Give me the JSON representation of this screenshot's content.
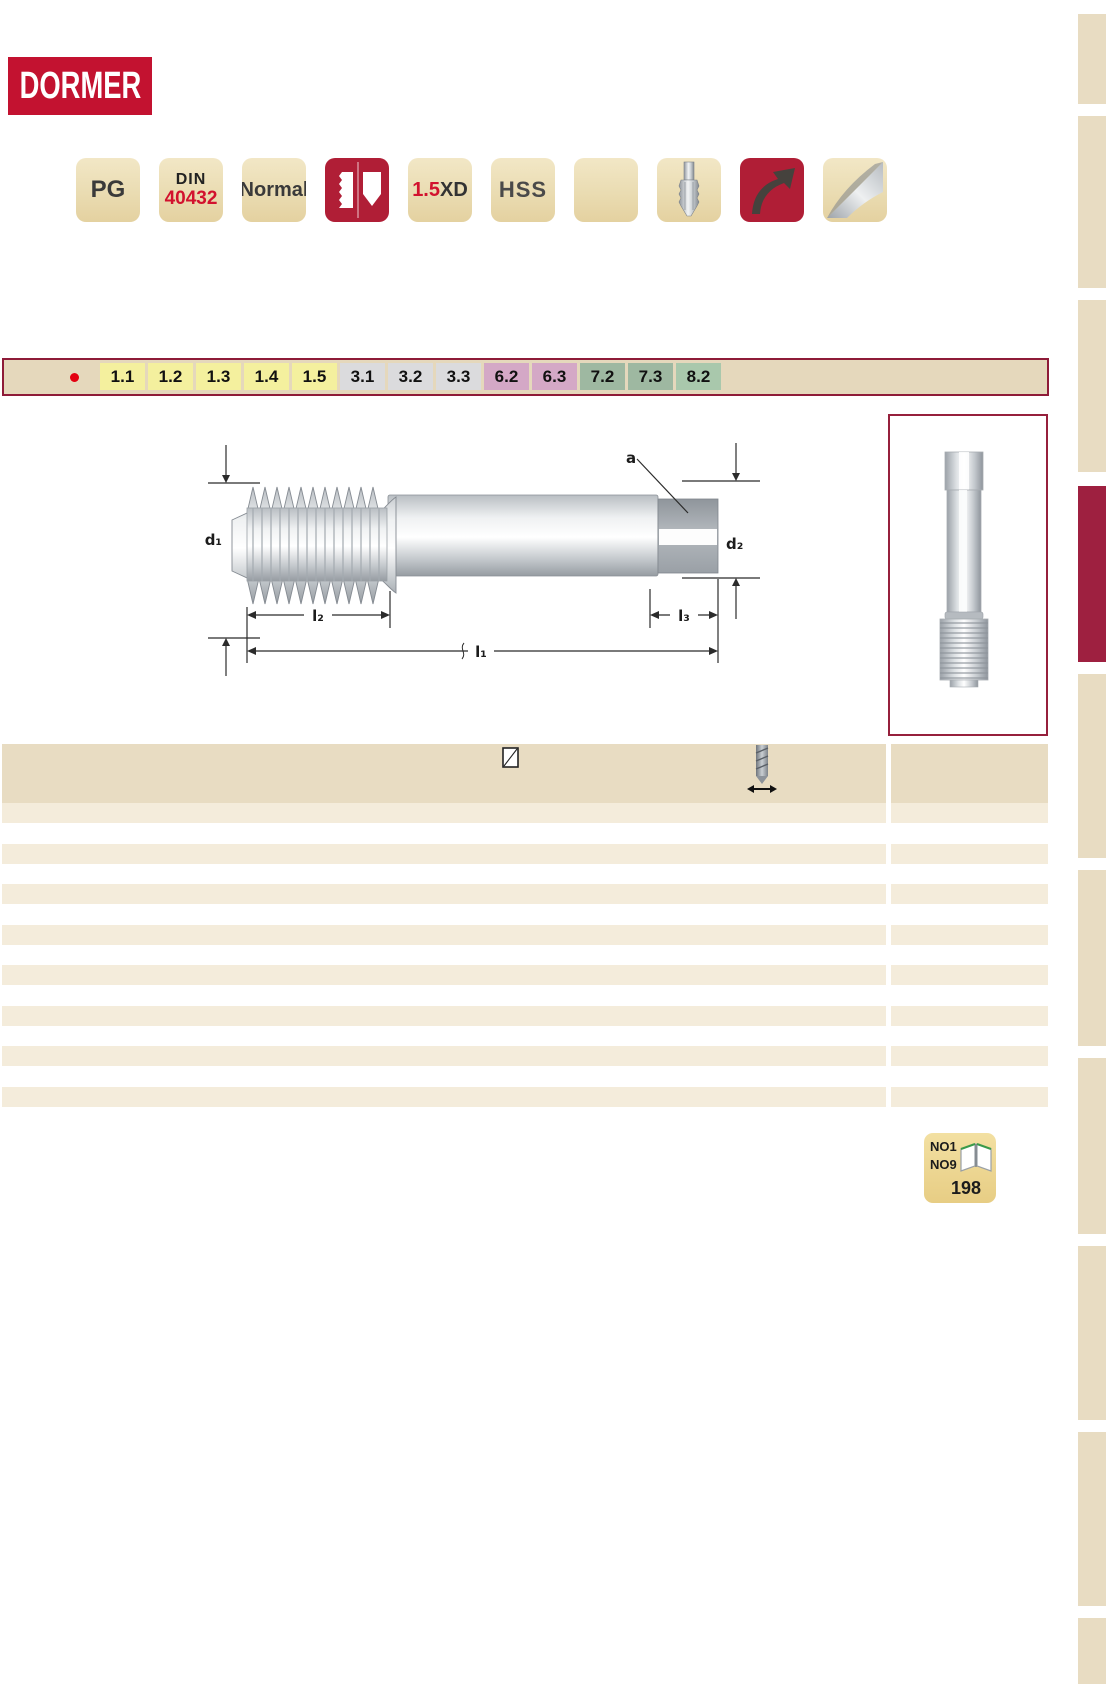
{
  "logo": {
    "text": "DORMER",
    "bg": "#C31230",
    "fg": "#FFFFFF"
  },
  "badges": {
    "pg": {
      "label": "PG"
    },
    "din": {
      "line1": "DIN",
      "line2": "40432"
    },
    "normal": {
      "label": "Normal"
    },
    "hole_type": {
      "icon": "blind-through-hole-icon",
      "bg": "#B01E36"
    },
    "xd": {
      "value": "1.5",
      "suffix": "XD"
    },
    "hss": {
      "label": "HSS"
    },
    "blank": {},
    "tap": {
      "icon": "tap-icon"
    },
    "recondition": {
      "icon": "curved-arrow-icon",
      "bg": "#B01E36"
    },
    "material": {
      "icon": "steel-material-icon"
    }
  },
  "strip": {
    "bullet_color": "#E30010",
    "cells": [
      {
        "label": "1.1",
        "bg": "#F4F09E"
      },
      {
        "label": "1.2",
        "bg": "#F4F09E"
      },
      {
        "label": "1.3",
        "bg": "#F4F09E"
      },
      {
        "label": "1.4",
        "bg": "#F4F09E"
      },
      {
        "label": "1.5",
        "bg": "#F4F09E"
      },
      {
        "label": "3.1",
        "bg": "#DBDBDD"
      },
      {
        "label": "3.2",
        "bg": "#DBDBDD"
      },
      {
        "label": "3.3",
        "bg": "#DBDBDD"
      },
      {
        "label": "6.2",
        "bg": "#D4A8C6"
      },
      {
        "label": "6.3",
        "bg": "#D4A8C6"
      },
      {
        "label": "7.2",
        "bg": "#9EB8A1"
      },
      {
        "label": "7.3",
        "bg": "#9EB8A1"
      },
      {
        "label": "8.2",
        "bg": "#A9C8AC"
      }
    ]
  },
  "diagram": {
    "labels": {
      "a": "a",
      "d1": "d₁",
      "d2": "d₂",
      "l1": "l₁",
      "l2": "l₂",
      "l3": "l₃"
    }
  },
  "table": {
    "header_icons": [
      "square-symbol-icon",
      "drill-diameter-icon"
    ],
    "rows": [
      "tan",
      "white",
      "tan",
      "white",
      "tan",
      "white",
      "tan",
      "white",
      "tan",
      "white",
      "tan",
      "white",
      "tan",
      "white",
      "tan"
    ]
  },
  "page_ref": {
    "ref1": "NO1",
    "ref2": "NO9",
    "page": "198"
  },
  "sidebar": {
    "blocks": [
      {
        "top": 14,
        "height": 90,
        "color": "#E8DCC2"
      },
      {
        "top": 116,
        "height": 172,
        "color": "#E8DCC2"
      },
      {
        "top": 300,
        "height": 172,
        "color": "#E8DCC2"
      },
      {
        "top": 486,
        "height": 176,
        "color": "#9E2040"
      },
      {
        "top": 674,
        "height": 184,
        "color": "#E8DCC2"
      },
      {
        "top": 870,
        "height": 176,
        "color": "#E8DCC2"
      },
      {
        "top": 1058,
        "height": 176,
        "color": "#E8DCC2"
      },
      {
        "top": 1246,
        "height": 174,
        "color": "#E8DCC2"
      },
      {
        "top": 1432,
        "height": 174,
        "color": "#E8DCC2"
      },
      {
        "top": 1618,
        "height": 66,
        "color": "#E8DCC2"
      }
    ]
  },
  "colors": {
    "logo_red": "#C31230",
    "badge_red": "#B01E36",
    "border_red": "#96203C",
    "strip_border": "#8E1B38",
    "sidebar_red": "#9E2040",
    "tan_header": "#E8DCC2",
    "tan_row": "#F4ECDB",
    "strip_bg": "#E5D8BC"
  }
}
